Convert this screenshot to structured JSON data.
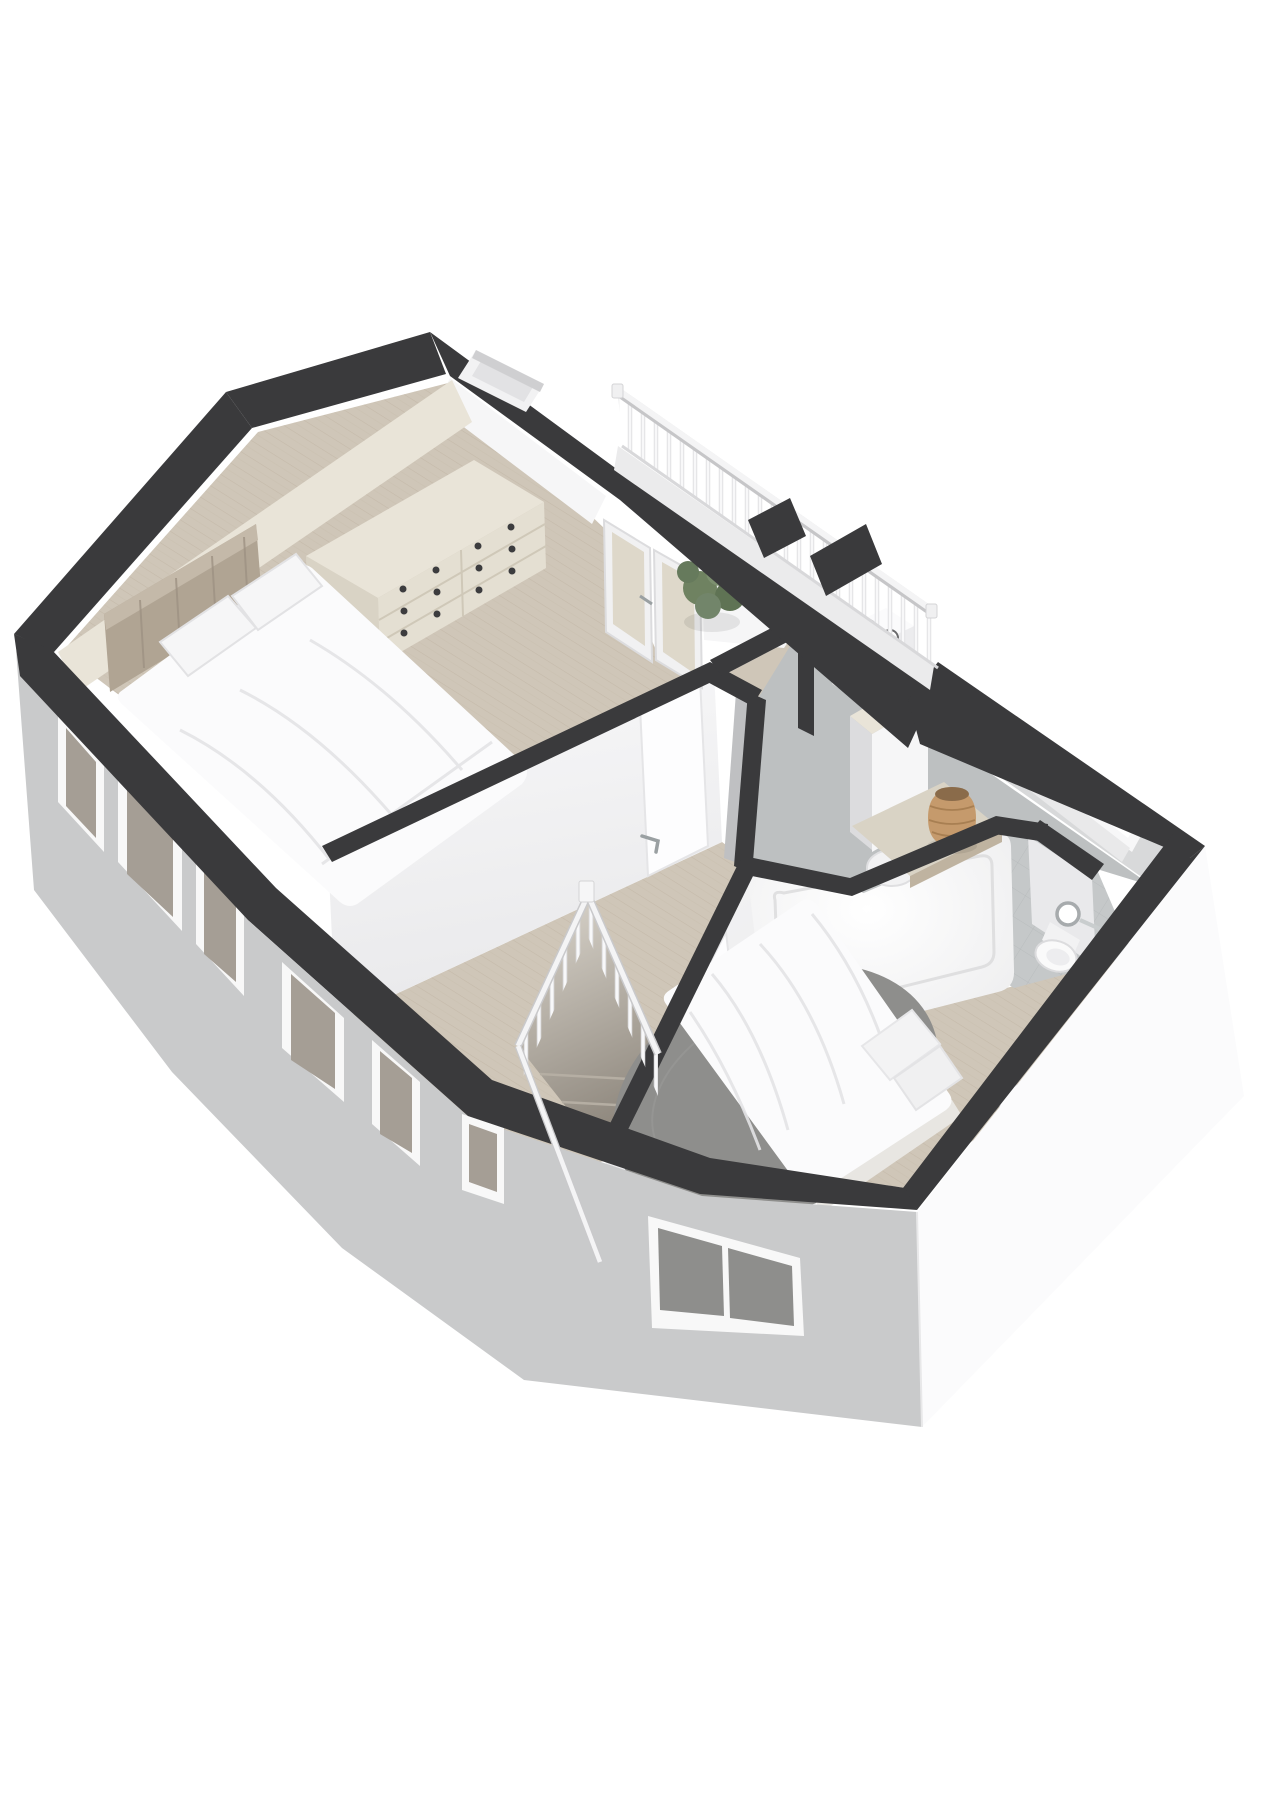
{
  "scene": {
    "type": "3d-floorplan-isometric",
    "background": "#ffffff",
    "storey": "upper-floor"
  },
  "colors": {
    "wall_cap": "#3a3a3c",
    "ext_sw": "#c9cacb",
    "ext_se": "#fbfbfc",
    "int_white": "#f6f6f7",
    "int_shadow": "#e9e9eb",
    "int_gray": "#bfc0c2",
    "ne_face": "#d8d9da",
    "wood": "#cfc6b8",
    "wood_line": "#b7ab99",
    "carpet": "#bdc0c1",
    "tile": "#c5c8c9",
    "tile_line": "#aeb2b3",
    "rug": "#8e8e8c",
    "cream": "#e9e4d8",
    "cream_dark": "#d9d3c5",
    "taupe": "#b0a493",
    "white_furn": "#fbfbfc",
    "glass": "#ded8ca",
    "glass_dark": "#a59e95",
    "green": "#6f8261",
    "green_dark": "#5f7354",
    "wood_cyl": "#b59378",
    "basket": "#c59a6c",
    "basket_dark": "#8a6b4a",
    "chrome": "#a7abad",
    "railing": "#f4f4f5",
    "railing_edge": "#d9d9db",
    "step_light": "#ddd8cf",
    "step_dark": "#8d867c",
    "knob": "#3c3c3e",
    "window_bright": "#ffffff",
    "balcony_floor": "#ebebec",
    "door_panel": "#fdfdfe"
  },
  "rooms": [
    {
      "name": "master-bedroom",
      "floor": "wood"
    },
    {
      "name": "landing",
      "floor": "wood"
    },
    {
      "name": "laundry-closet",
      "floor": "wood"
    },
    {
      "name": "office",
      "floor": "carpet"
    },
    {
      "name": "bathroom",
      "floor": "tile"
    },
    {
      "name": "second-bedroom",
      "floor": "wood"
    },
    {
      "name": "balcony",
      "floor": "deck"
    }
  ],
  "furniture": [
    "double-bed",
    "upholstered-headboard",
    "pillows",
    "drawer-dresser",
    "round-side-table",
    "potted-plant",
    "french-doors",
    "chimney-shaft",
    "balcony-railing",
    "balcony-chairs",
    "washing-machine",
    "wardrobe",
    "desk",
    "desk-chair",
    "storage-basket",
    "bathtub",
    "toilet",
    "towel-ring",
    "staircase",
    "stair-railing",
    "single-bed",
    "round-rug",
    "table-lamp",
    "door-with-handle"
  ]
}
